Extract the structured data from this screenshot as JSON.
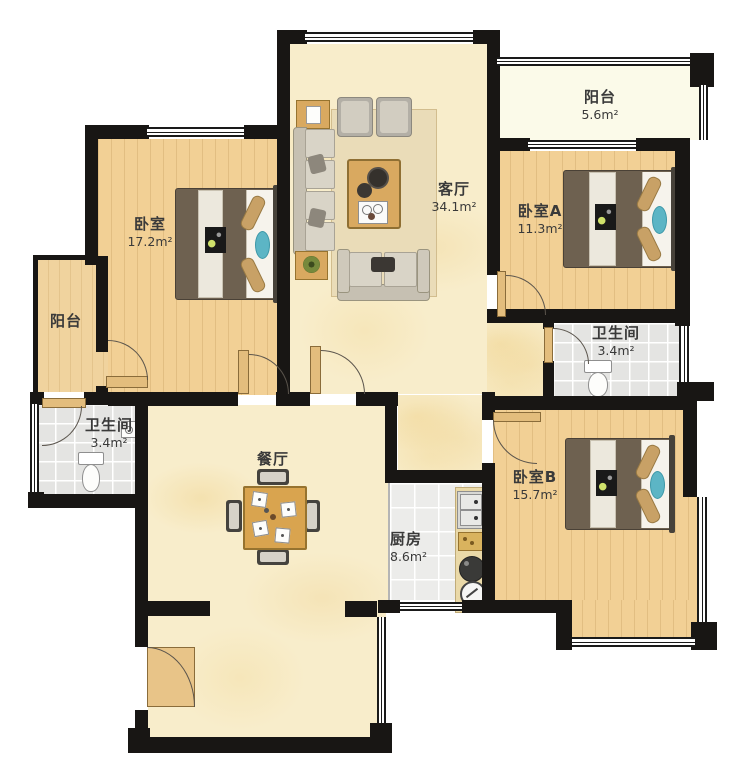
{
  "title": "apartment-floor-plan",
  "colors": {
    "wall": "#181614",
    "wood_floor": "#f2d095",
    "cream_floor": "#f8edcb",
    "tile_floor": "#e4e4e2",
    "balcony_floor": "#fbfae9",
    "door_leaf": "#e3bd7d",
    "bed_accent_teal": "#5cb5c5",
    "label_text": "#3a3a3a"
  },
  "rooms": [
    {
      "id": "bedroom-main",
      "name": "卧室",
      "area": "17.2m²"
    },
    {
      "id": "living-room",
      "name": "客厅",
      "area": "34.1m²"
    },
    {
      "id": "bedroom-a",
      "name": "卧室A",
      "area": "11.3m²"
    },
    {
      "id": "balcony-top",
      "name": "阳台",
      "area": "5.6m²"
    },
    {
      "id": "bathroom-right",
      "name": "卫生间",
      "area": "3.4m²"
    },
    {
      "id": "balcony-left",
      "name": "阳台",
      "area": ""
    },
    {
      "id": "bathroom-left",
      "name": "卫生间",
      "area": "3.4m²"
    },
    {
      "id": "dining-room",
      "name": "餐厅",
      "area": ""
    },
    {
      "id": "kitchen",
      "name": "厨房",
      "area": "8.6m²"
    },
    {
      "id": "bedroom-b",
      "name": "卧室B",
      "area": "15.7m²"
    }
  ]
}
